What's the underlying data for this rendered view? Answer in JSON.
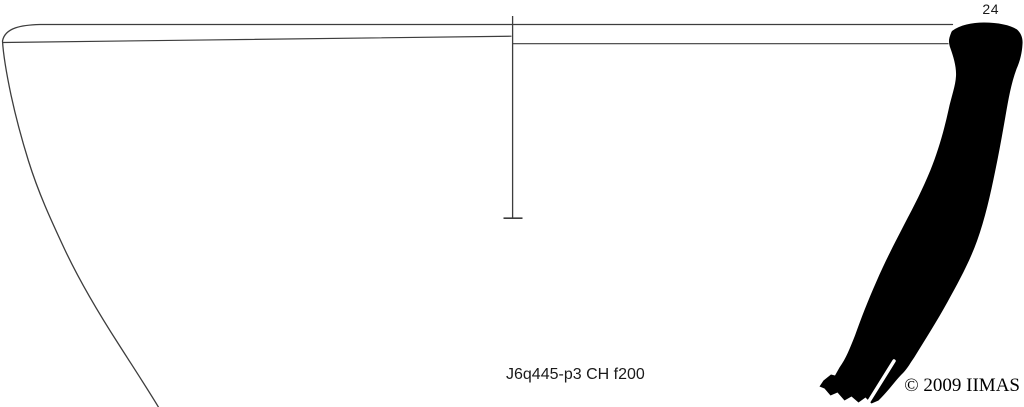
{
  "plate": {
    "number": "24",
    "caption": "J6q445-p3 CH f200",
    "copyright": "© 2009 IIMAS"
  },
  "colors": {
    "background": "#ffffff",
    "ink": "#000000",
    "outline": "#3d3d3d",
    "text": "#1a1a1a"
  }
}
